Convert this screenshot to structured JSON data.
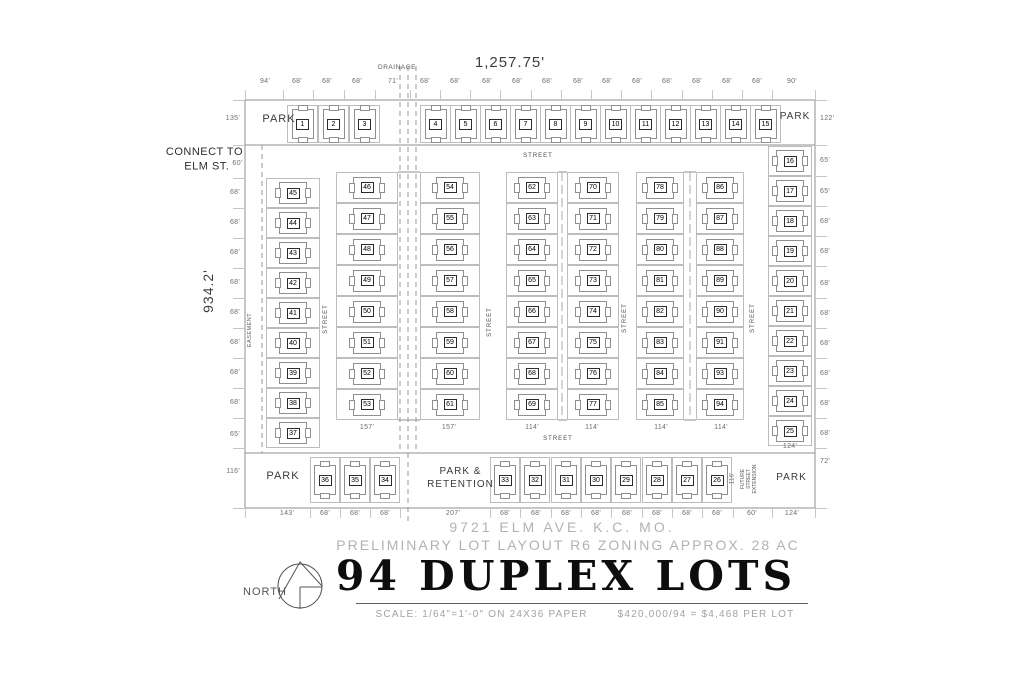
{
  "document": {
    "address_line": "9721 ELM AVE. K.C. MO.",
    "subtitle": "PRELIMINARY LOT LAYOUT R6 ZONING APPROX. 28 AC",
    "title": "94 DUPLEX LOTS",
    "scale_note": "SCALE: 1/64\"=1'-0\" ON 24X36 PAPER",
    "price_note": "$420,000/94 = $4,468 PER LOT",
    "north_label": "NORTH"
  },
  "site": {
    "overall_width": "1,257.75'",
    "overall_height": "934.2'",
    "connect_line1": "CONNECT TO",
    "connect_line2": "ELM ST.",
    "connect_dim": "60'",
    "drainage_label": "DRAINAGE",
    "easement_label": "EASEMENT",
    "street_label": "STREET",
    "park_label": "PARK",
    "park_retention_label": "PARK &\nRETENTION",
    "future_street_label": "FUTURE\nSTREET\nEXTENSION",
    "future_street_dim": "116'"
  },
  "lot_groups": {
    "top_row": [
      1,
      2,
      3,
      4,
      5,
      6,
      7,
      8,
      9,
      10,
      11,
      12,
      13,
      14,
      15
    ],
    "right_col": [
      16,
      17,
      18,
      19,
      20,
      21,
      22,
      23,
      24,
      25
    ],
    "left_col": [
      45,
      44,
      43,
      42,
      41,
      40,
      39,
      38,
      37
    ],
    "block_a_left": [
      46,
      47,
      48,
      49,
      50,
      51,
      52,
      53
    ],
    "block_a_right": [
      54,
      55,
      56,
      57,
      58,
      59,
      60,
      61
    ],
    "block_b_left": [
      62,
      63,
      64,
      65,
      66,
      67,
      68,
      69
    ],
    "block_b_right": [
      70,
      71,
      72,
      73,
      74,
      75,
      76,
      77
    ],
    "block_c_left": [
      78,
      79,
      80,
      81,
      82,
      83,
      84,
      85
    ],
    "block_c_right": [
      86,
      87,
      88,
      89,
      90,
      91,
      93,
      94
    ],
    "bottom_left_row": [
      36,
      35,
      34
    ],
    "bottom_right_row": [
      33,
      32,
      31,
      30,
      29,
      28,
      27,
      26
    ]
  },
  "dims": {
    "top": [
      "94'",
      "68'",
      "68'",
      "68'",
      "71'",
      "68'",
      "68'",
      "68'",
      "68'",
      "68'",
      "68'",
      "68'",
      "68'",
      "68'",
      "68'",
      "68'",
      "68'",
      "90'"
    ],
    "left": [
      "135'",
      "68'",
      "68'",
      "68'",
      "68'",
      "68'",
      "68'",
      "68'",
      "68'",
      "65'",
      "116'"
    ],
    "right": [
      "122'",
      "65'",
      "65'",
      "68'",
      "68'",
      "68'",
      "68'",
      "68'",
      "68'",
      "68'",
      "68'",
      "72'"
    ],
    "bottom": [
      "143'",
      "68'",
      "68'",
      "68'",
      "207'",
      "68'",
      "68'",
      "68'",
      "68'",
      "68'",
      "68'",
      "68'",
      "68'",
      "60'",
      "124'"
    ],
    "block_bottoms": [
      "157'",
      "157'",
      "114'",
      "114'",
      "114'",
      "114'"
    ],
    "right_col_bottom": "124'"
  }
}
